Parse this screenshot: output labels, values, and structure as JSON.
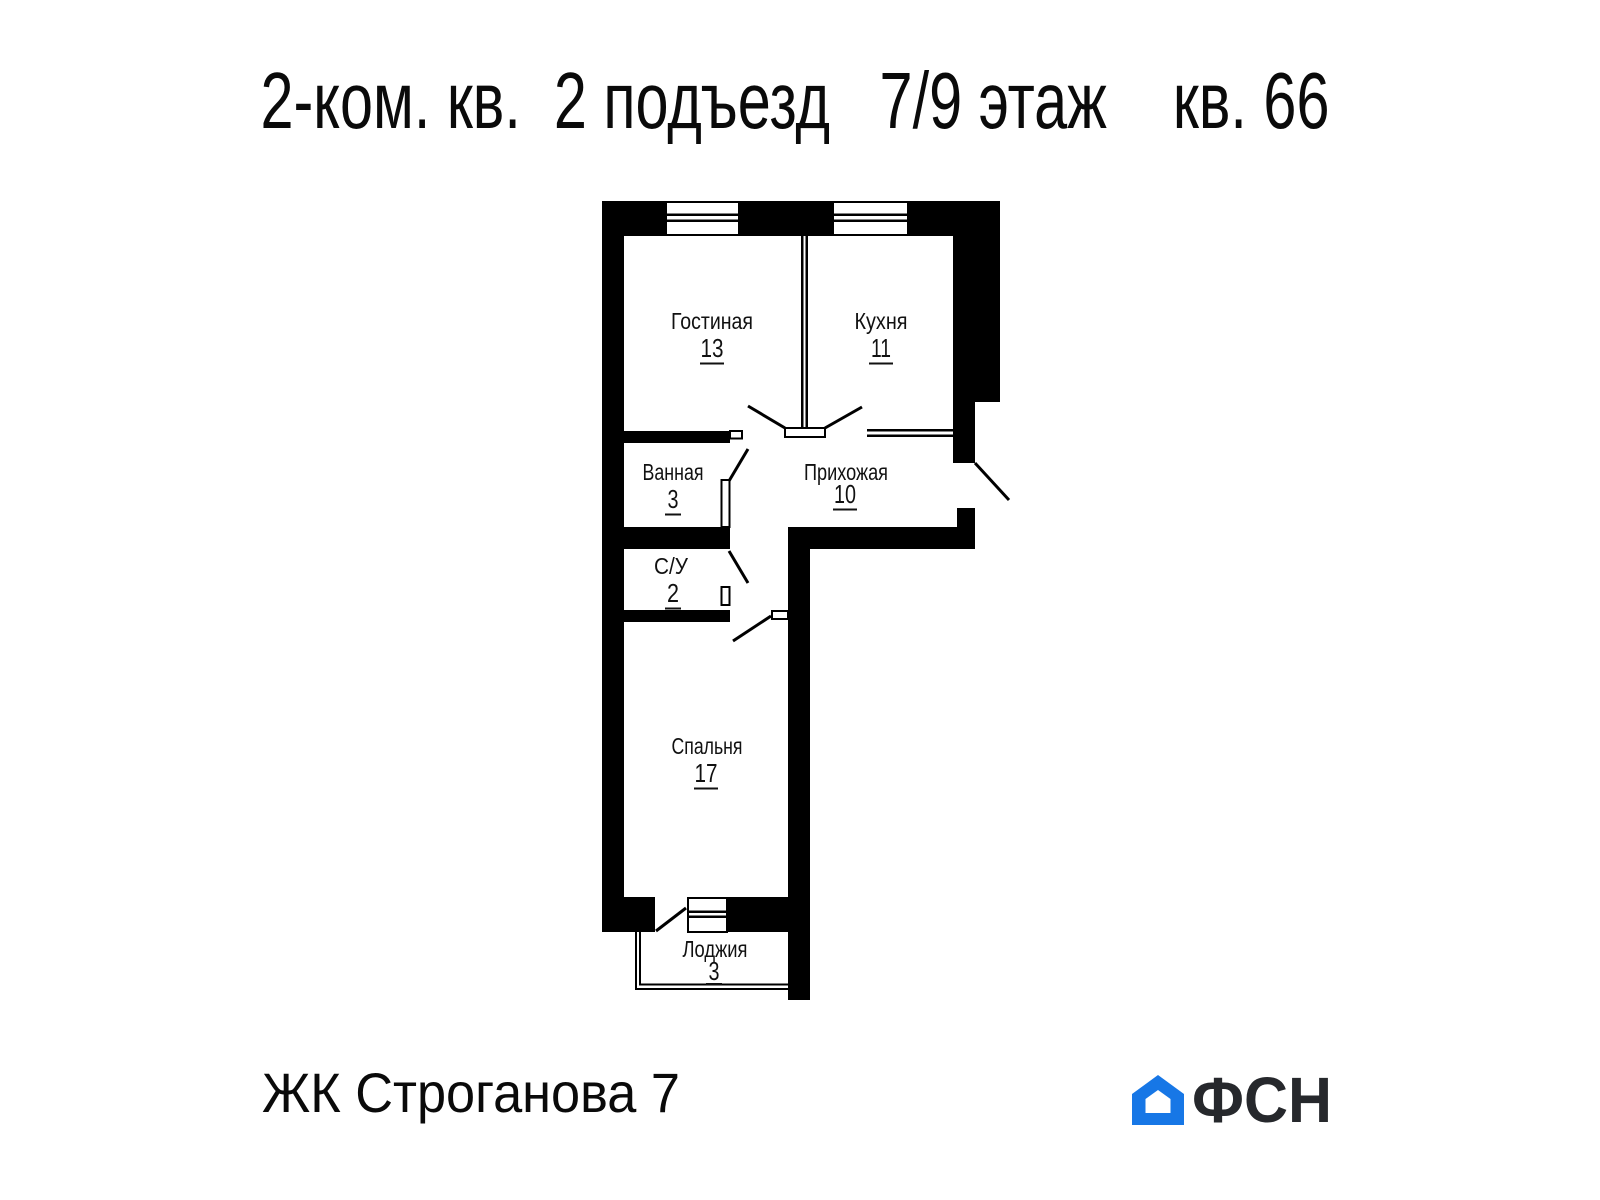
{
  "title": "2-ком. кв.  2 подъезд   7/9 этаж    кв. 66",
  "plan": {
    "rooms": [
      {
        "name": "Гостиная",
        "area": "13"
      },
      {
        "name": "Кухня",
        "area": "11"
      },
      {
        "name": "Ванная",
        "area": "3"
      },
      {
        "name": "Прихожая",
        "area": "10"
      },
      {
        "name": "С/У",
        "area": "2"
      },
      {
        "name": "Спальня",
        "area": "17"
      },
      {
        "name": "Лоджия",
        "area": "3"
      }
    ]
  },
  "footer": {
    "complex": "ЖК Строганова 7",
    "logo": "ФСН"
  },
  "colors": {
    "walls": "#000000",
    "logo_blue": "#1777e6",
    "logo_dark": "#26282c"
  }
}
